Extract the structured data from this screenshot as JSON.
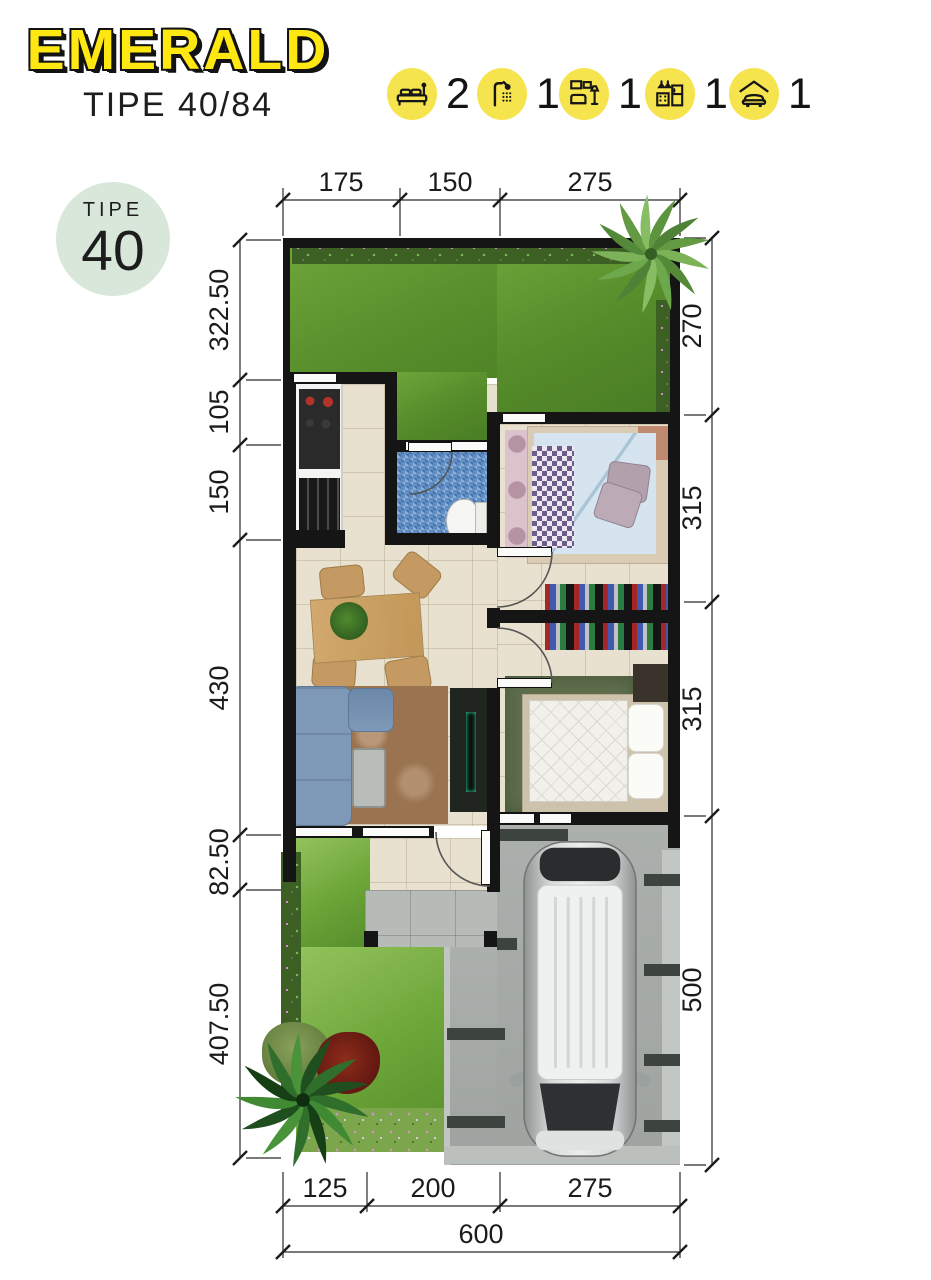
{
  "header": {
    "title": "EMERALD",
    "subtitle": "TIPE 40/84"
  },
  "badge": {
    "label": "TIPE",
    "value": "40"
  },
  "features": [
    {
      "icon": "bed-icon",
      "label": "bedrooms",
      "count": "2"
    },
    {
      "icon": "shower-icon",
      "label": "bathrooms",
      "count": "1"
    },
    {
      "icon": "livingroom-icon",
      "label": "living-room",
      "count": "1"
    },
    {
      "icon": "kitchen-icon",
      "label": "kitchen",
      "count": "1"
    },
    {
      "icon": "carport-icon",
      "label": "carport",
      "count": "1"
    }
  ],
  "dimensions": {
    "top": [
      "175",
      "150",
      "275"
    ],
    "left": [
      "322.50",
      "105",
      "150",
      "430",
      "82.50",
      "407.50"
    ],
    "right": [
      "270",
      "315",
      "315",
      "500"
    ],
    "bottom": [
      "125",
      "200",
      "275"
    ],
    "total": "600"
  },
  "colors": {
    "accent_yellow": "#f6e44f",
    "title_yellow": "#ffe712",
    "badge_green": "#d8e7da",
    "wall_black": "#151515",
    "grass_green": "#568c2a",
    "floor_beige": "#e9e1cf",
    "bath_blue": "#5e8ec4",
    "paving_gray": "#a6aba8"
  }
}
